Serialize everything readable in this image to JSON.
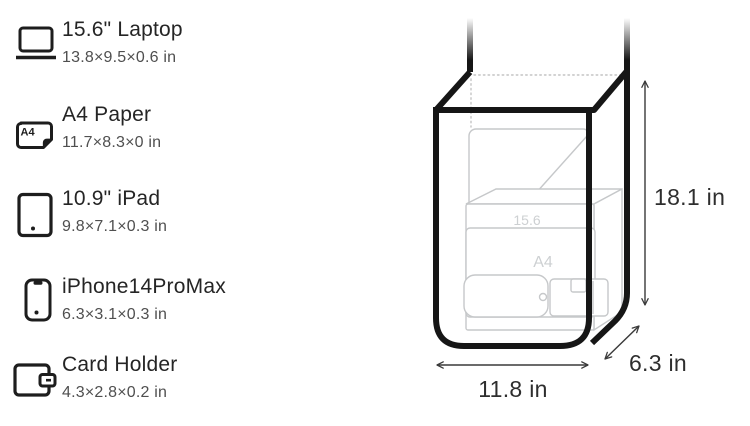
{
  "figure": {
    "type": "product-dimension-comparison"
  },
  "comparison_items": [
    {
      "title": "15.6\" Laptop",
      "dimensions": "13.8×9.5×0.6 in",
      "icon": "laptop-icon"
    },
    {
      "title": "A4 Paper",
      "dimensions": "11.7×8.3×0 in",
      "icon": "a4-paper-icon"
    },
    {
      "title": "10.9\" iPad",
      "dimensions": "9.8×7.1×0.3 in",
      "icon": "ipad-icon"
    },
    {
      "title": "iPhone14ProMax",
      "dimensions": "6.3×3.1×0.3 in",
      "icon": "iphone-icon"
    },
    {
      "title": "Card Holder",
      "dimensions": "4.3×2.8×0.2 in",
      "icon": "card-holder-icon"
    }
  ],
  "icon_labels": {
    "a4_badge": "A4"
  },
  "bag_diagram": {
    "height_label": "18.1 in",
    "width_label": "11.8 in",
    "depth_label": "6.3 in",
    "inner_item_labels": {
      "laptop": "15.6",
      "a4_paper": "A4"
    },
    "colors": {
      "bag_outline": "#161616",
      "inner_outline": "#c6c8ca",
      "inner_label_text": "#cdd0d2",
      "dotted_edge": "#c4c4c4",
      "dimension_line": "#3a3a3a",
      "dimension_text": "#2e2e2e",
      "title_text": "#252525",
      "subtitle_text": "#4f4f4f",
      "background": "#ffffff"
    }
  }
}
